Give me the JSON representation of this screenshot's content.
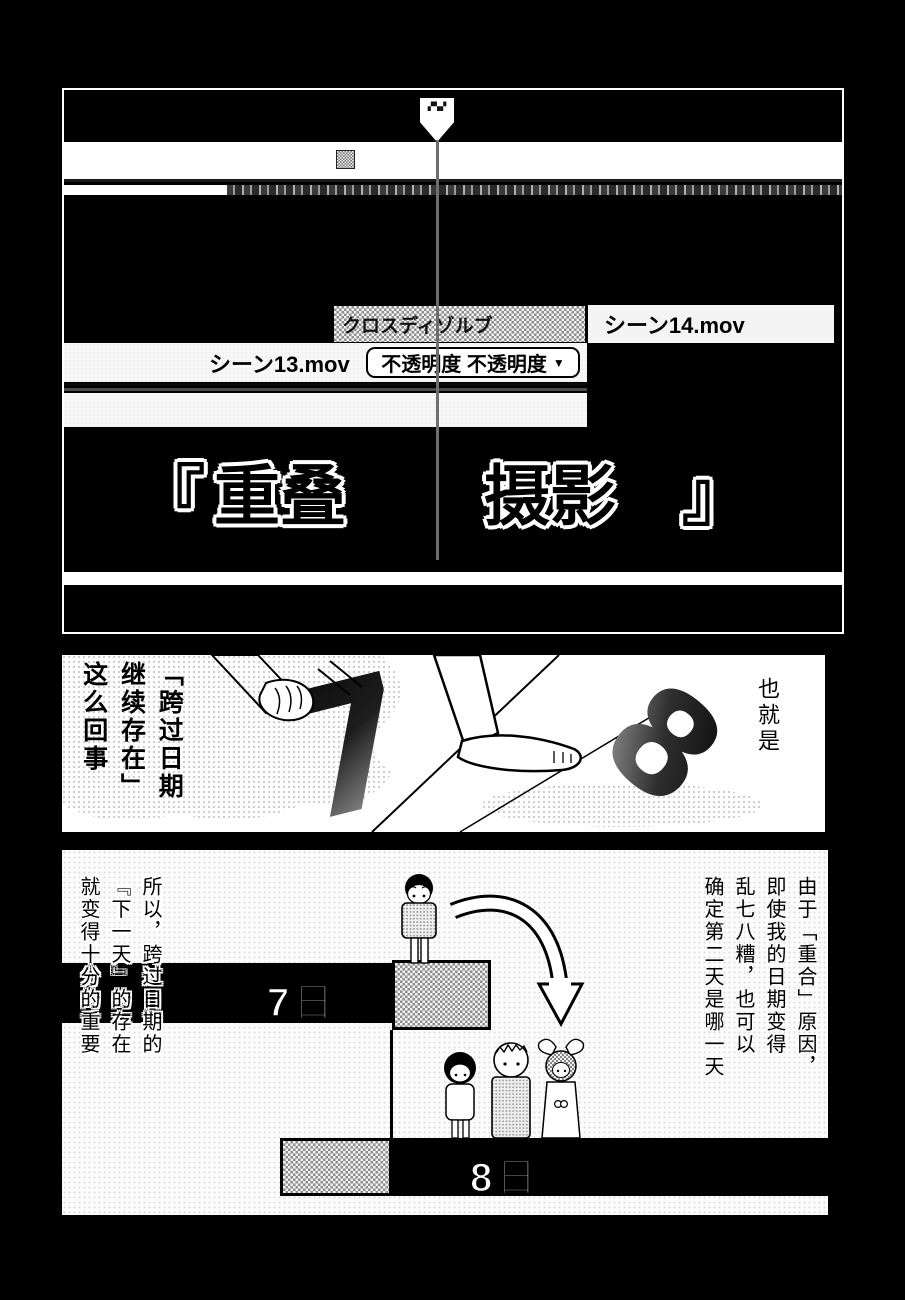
{
  "colors": {
    "page_bg": "#000000",
    "panel_bg": "#ffffff",
    "ink": "#000000",
    "halftone_gray": "#8f8f8f"
  },
  "editor": {
    "playhead_flag_glyphs": "▞▚▞",
    "clip_cross_dissolve": "クロスディゾルブ",
    "clip_scene14": "シーン14.mov",
    "clip_scene13": "シーン13.mov",
    "opacity_label": "不透明度 不透明度",
    "opacity_caret": "▼",
    "title_open": "『",
    "title_word1": "重叠",
    "title_word2": "摄影",
    "title_close": "』"
  },
  "middle": {
    "digit_left": "7",
    "digit_right": "8",
    "caption_left": [
      "「跨过日期",
      "继续存在」",
      "这么回事"
    ],
    "caption_right": "也就是"
  },
  "bottom": {
    "narration_right": [
      "由于「重合」原因，",
      "即使我的日期变得",
      "乱七八糟，也可以",
      "确定第二天是哪一天"
    ],
    "narration_left": [
      "所以，跨过日期的",
      "『下一天』的存在",
      "就变得十分的重要"
    ],
    "day7_label": "7日",
    "day8_label": "8日"
  }
}
